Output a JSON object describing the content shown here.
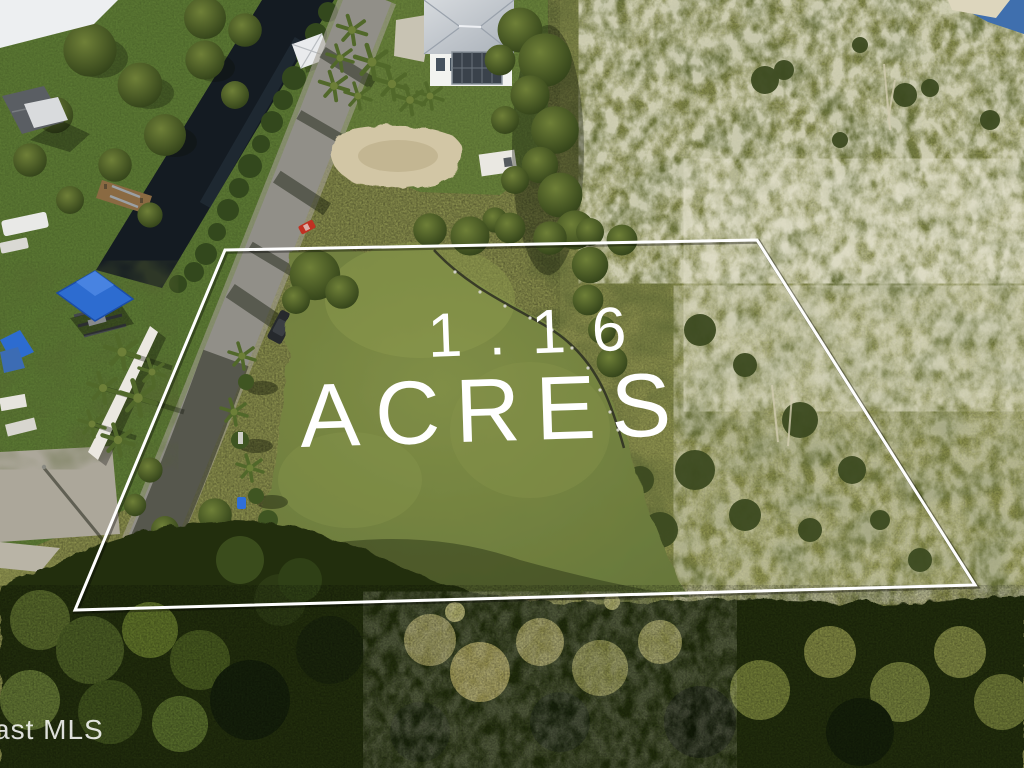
{
  "photo": {
    "type": "aerial-real-estate-photo",
    "lot_label": {
      "line1": "1.16",
      "line2": "ACRES",
      "color": "#ffffff"
    },
    "watermark": {
      "text": "ast MLS",
      "color": "#ffffff"
    },
    "boundary": {
      "points": "225,250 757,240 975,585 75,610",
      "color": "#ffffff"
    },
    "scene": {
      "water_color": "#141b22",
      "lagoon_color": "#3f6fae",
      "road_color": "#918f88",
      "grass_color": "#74823e",
      "scrub_color": "#8a8e50",
      "canopy_color": "#232d11",
      "blue_roof_color": "#2d6cd0",
      "house_roof_color": "#ccd2d8",
      "red_car_color": "#c03122",
      "dark_car_color": "#26292d"
    }
  }
}
